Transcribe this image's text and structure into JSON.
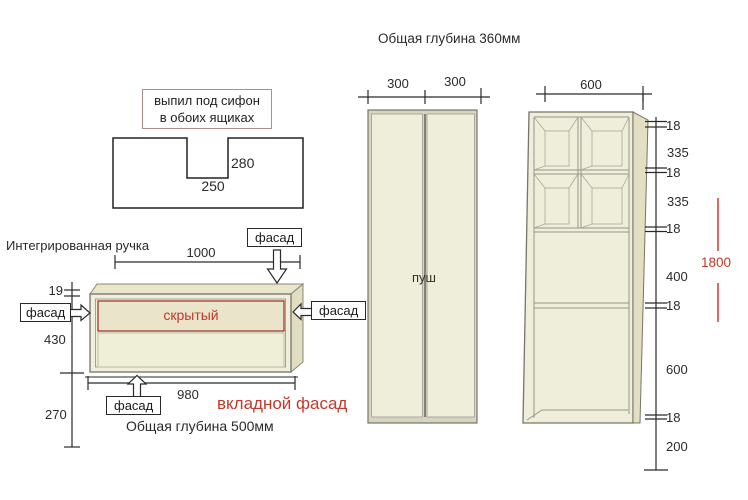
{
  "labels": {
    "facade": "фасад",
    "handle": "Интегрированная ручка",
    "hidden": "скрытый",
    "inset_facade": "вкладной фасад",
    "depth500": "Общая глубина 500мм",
    "depth360": "Общая глубина 360мм",
    "push": "пуш"
  },
  "siphon_note": {
    "line1": "выпил под сифон",
    "line2": "в обоих ящиках"
  },
  "siphon_dims": {
    "depth": "280",
    "width": "250"
  },
  "drawer_dims": {
    "width_top": "1000",
    "edge": "19",
    "height": "430",
    "bottom_gap": "270",
    "width_bottom": "980"
  },
  "tall_cabinet_dims": {
    "door_left": "300",
    "door_right": "300"
  },
  "shelf_cabinet_dims": {
    "width": "600",
    "right": [
      "18",
      "335",
      "18",
      "335",
      "18",
      "400",
      "18",
      "600",
      "18",
      "200"
    ],
    "total": "1800"
  },
  "colors": {
    "accent_red": "#c0392b",
    "cabinet_fill": "#f0efdb",
    "cabinet_side": "#e0ddc1",
    "line_dark": "#2a2a2a"
  }
}
